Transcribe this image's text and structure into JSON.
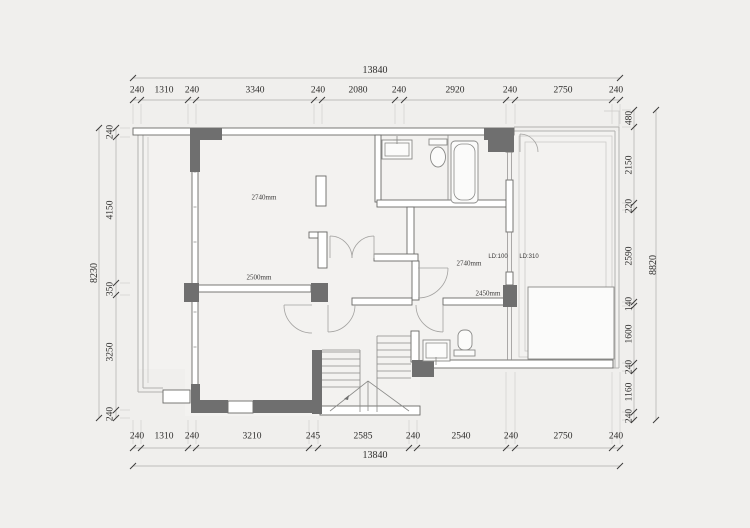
{
  "drawing": {
    "type": "architectural-floor-plan",
    "dimensions": {
      "top": {
        "total": "13840",
        "segments": [
          "240",
          "1310",
          "240",
          "3340",
          "240",
          "2080",
          "240",
          "2920",
          "240",
          "2750",
          "240"
        ]
      },
      "bottom": {
        "total": "13840",
        "segments": [
          "240",
          "1310",
          "240",
          "3210",
          "245",
          "2585",
          "240",
          "2540",
          "240",
          "2750",
          "240"
        ]
      },
      "left": {
        "total": "8230",
        "segments": [
          "240",
          "4150",
          "350",
          "3250",
          "240"
        ]
      },
      "right": {
        "total": "8820",
        "segments": [
          "480",
          "2150",
          "220",
          "2590",
          "140",
          "1600",
          "240",
          "1160",
          "240"
        ]
      }
    },
    "room_labels": [
      "2740mm",
      "2500mm",
      "2740mm",
      "2450mm"
    ],
    "window_labels": [
      "LD:100",
      "LD:310"
    ],
    "colors": {
      "bg": "#f0efed",
      "paper": "#f3f2f0",
      "wall_dark": "#6f6f6f",
      "wall_stroke": "#6a6a68",
      "line_light": "#b2b1af",
      "line_faint": "#cbcac8",
      "fixture": "#8a8a88",
      "arc": "#a3a2a0",
      "dim_line": "#aeadab",
      "dim_text": "#2e2d2c"
    }
  }
}
